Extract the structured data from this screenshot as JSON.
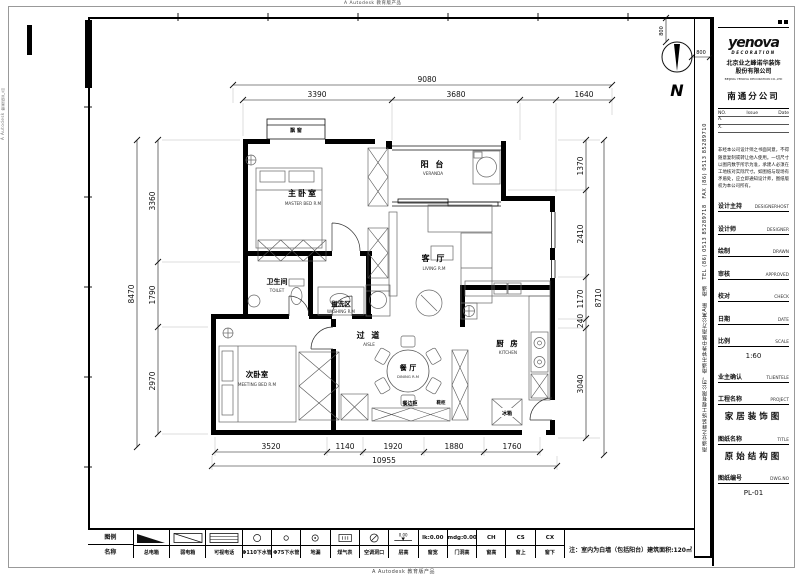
{
  "autodesk_watermark": "A Autodesk 教育版产品",
  "compass": {
    "label": "N",
    "dim_vertical": "800",
    "dim_horizontal": "800"
  },
  "dims": {
    "top": {
      "overall": "9080",
      "segments": [
        "3390",
        "3680",
        "1640"
      ]
    },
    "left": {
      "overall": "8470",
      "segments": [
        "3360",
        "1790",
        "2970"
      ]
    },
    "right": {
      "overall": "8710",
      "segments": [
        "1370",
        "2410",
        "1170",
        "240",
        "3040"
      ]
    },
    "bottom": {
      "overall": "10955",
      "segments": [
        "3520",
        "1140",
        "1920",
        "1880",
        "1760"
      ]
    }
  },
  "rooms": {
    "master": {
      "cn": "主卧室",
      "en": "MASTER BED R.M"
    },
    "bay": {
      "cn": "飘 窗"
    },
    "veranda": {
      "cn": "阳 台",
      "en": "VERANDA"
    },
    "living": {
      "cn": "客 厅",
      "en": "LIVING R.M"
    },
    "toilet": {
      "cn": "卫生间",
      "en": "TOILET"
    },
    "washing": {
      "cn": "盥洗区",
      "en": "WASHING R.M"
    },
    "aisle": {
      "cn": "过 道",
      "en": "AISLE"
    },
    "second": {
      "cn": "次卧室",
      "en": "MEETING BED R.M"
    },
    "dining": {
      "cn": "餐 厅",
      "en": "DINING R.M"
    },
    "kitchen": {
      "cn": "厨 房",
      "en": "KITCHEN"
    },
    "fridge": "冰箱",
    "sideboard": "餐边柜",
    "shoe_cabinet": "鞋柜"
  },
  "legend": {
    "header_row1": "图例",
    "header_row2": "名称",
    "items": [
      {
        "label": "总电箱",
        "sym": "tri"
      },
      {
        "label": "弱电箱",
        "sym": "diag"
      },
      {
        "label": "可视电话",
        "sym": "lines"
      },
      {
        "label": "Φ110下水管",
        "sym": "cmd"
      },
      {
        "label": "Φ75下水管",
        "sym": "csm"
      },
      {
        "label": "地漏",
        "sym": "cdot"
      },
      {
        "label": "煤气表",
        "sym": "meter"
      },
      {
        "label": "空调洞口",
        "sym": "ck"
      },
      {
        "label": "层高",
        "sym": "level"
      },
      {
        "label": "窗宽",
        "sym": "text",
        "symText": "lk:0.00"
      },
      {
        "label": "门洞高",
        "sym": "text",
        "symText": "mdg:0.00"
      },
      {
        "label": "窗高",
        "sym": "text",
        "symText": "CH"
      },
      {
        "label": "窗上",
        "sym": "text",
        "symText": "CS"
      },
      {
        "label": "窗下",
        "sym": "text",
        "symText": "CX"
      }
    ],
    "note": "注：室内为白墙（包括阳台）建筑面积:120㎡"
  },
  "titleblock": {
    "logo_text": "yenova",
    "logo_sub": "DECORATION",
    "company_cn": "北京业之峰诺华装饰\n股份有限公司",
    "company_en": "BEIJING YENOVA DECORATION CO.,LTD",
    "branch": "南通分公司",
    "revision": {
      "col1": "NO.",
      "col2": "Issue",
      "col3": "Date",
      "rows": [
        "A.",
        "X."
      ]
    },
    "disclaimer": "非经本公司设计师之书面同意，不得随意复制或转让他人使用。一切尺寸以图内数字所示为准，承建人必须在工地核对实际尺寸。如图纸与现场有矛盾处，应立即通知设计师，图纸版权为本公司所有。",
    "fields": [
      {
        "cn": "设计主持",
        "en": "DESIGNERHOST"
      },
      {
        "cn": "设计师",
        "en": "DESIGNER"
      },
      {
        "cn": "绘制",
        "en": "DRAWN"
      },
      {
        "cn": "审核",
        "en": "APPROVED"
      },
      {
        "cn": "校对",
        "en": "CHECK"
      },
      {
        "cn": "日期",
        "en": "DATE"
      },
      {
        "cn": "比例",
        "en": "SCALE",
        "value": "1:60"
      },
      {
        "cn": "业主确认",
        "en": "TLIENTELE"
      },
      {
        "cn": "工程名称",
        "en": "PROJECT",
        "value": "家居装饰图",
        "big": true
      },
      {
        "cn": "图纸名称",
        "en": "TITLE",
        "value": "原始结构图",
        "big": true
      },
      {
        "cn": "图纸编号",
        "en": "DWG.NO",
        "value": "PL-01"
      }
    ]
  },
  "side_company_text": "南通业之峰装饰工程有限公司，南通市钟秀中路南方公寓A座　南通　TEL (86) 0513 85289718　FAX (86) 0513 85289710"
}
